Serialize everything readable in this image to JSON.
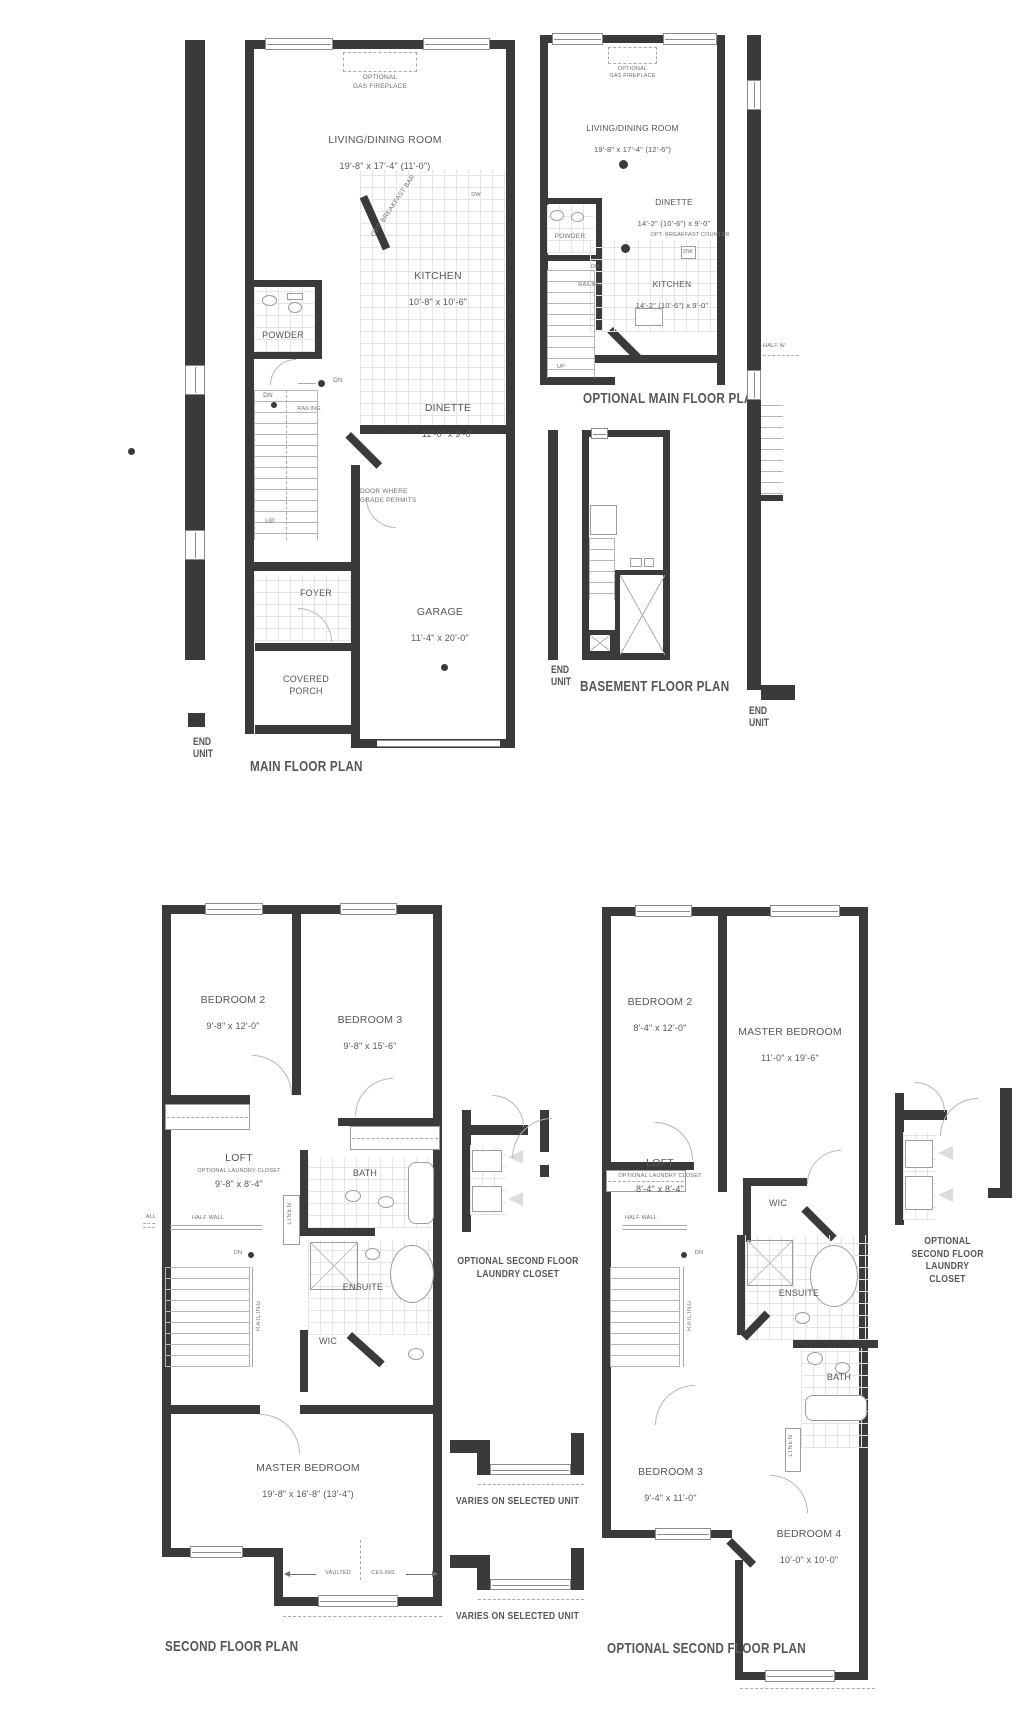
{
  "sheet": {
    "bg": "#ffffff",
    "wall_color": "#3a3a3c",
    "line_color": "#a7a9ac",
    "label_color": "#55575b",
    "title_color": "#55565a"
  },
  "main_floor": {
    "title": "MAIN FLOOR PLAN",
    "end_unit_label": "END\nUNIT",
    "optional_gas_fireplace": "OPTIONAL\nGAS FIREPLACE",
    "living_dining": {
      "name": "LIVING/DINING ROOM",
      "dims": "19'-8\" x 17'-4\" (11'-0\")"
    },
    "opt_breakfast_bar": "OPT. BREAKFAST BAR",
    "kitchen": {
      "name": "KITCHEN",
      "dims": "10'-8\" x 10'-6\""
    },
    "dw": "DW",
    "powder": "POWDER",
    "dinette": {
      "name": "DINETTE",
      "dims": "11'-0\" x 9'-0\""
    },
    "dn_upper": "DN",
    "dn_lower": "DN",
    "up": "UP",
    "railing": "RAILING",
    "door_note": "DOOR WHERE\nGRADE PERMITS",
    "foyer": "FOYER",
    "garage": {
      "name": "GARAGE",
      "dims": "11'-4\" x 20'-0\""
    },
    "covered_porch": "COVERED\nPORCH"
  },
  "optional_main": {
    "title": "OPTIONAL MAIN FLOOR PLAN",
    "optional_gas_fireplace": "OPTIONAL\nGAS FIREPLACE",
    "living_dining": {
      "name": "LIVING/DINING ROOM",
      "dims": "19'-8\" x 17'-4\" (12'-6\")"
    },
    "dinette": {
      "name": "DINETTE",
      "dims": "14'-2\" (10'-6\") x 9'-0\""
    },
    "powder": "POWDER",
    "opt_breakfast_counter": "OPT. BREAKFAST COUNTER",
    "kitchen": {
      "name": "KITCHEN",
      "dims": "14'-2\" (10'-6\") x 9'-0\""
    },
    "dw": "DW",
    "dn": "DN",
    "railing": "RAILING",
    "up": "UP"
  },
  "basement": {
    "title": "BASEMENT FLOOR PLAN",
    "end_unit_label": "END\nUNIT"
  },
  "end_wall": {
    "half_wall": "HALF W",
    "end_unit_label": "END\nUNIT"
  },
  "second_floor": {
    "title": "SECOND FLOOR PLAN",
    "bedroom2": {
      "name": "BEDROOM 2",
      "dims": "9'-8\" x 12'-0\""
    },
    "bedroom3": {
      "name": "BEDROOM 3",
      "dims": "9'-8\" x 15'-6\""
    },
    "loft": {
      "name": "LOFT",
      "dims": "9'-8\" x 8'-4\"",
      "note": "OPTIONAL LAUNDRY CLOSET"
    },
    "bath": "BATH",
    "linen": "LINEN",
    "half_wall": "HALF WALL",
    "side_note": "ALL",
    "dn": "DN",
    "railing": "RAILING",
    "ensuite": "ENSUITE",
    "wic": "WIC",
    "master": {
      "name": "MASTER BEDROOM",
      "dims": "19'-8\" x 16'-8\" (13'-4\")"
    },
    "vaulted_left": "VAULTED",
    "vaulted_right": "CEILING"
  },
  "optional_second": {
    "title": "OPTIONAL SECOND FLOOR PLAN",
    "bedroom2": {
      "name": "BEDROOM 2",
      "dims": "8'-4\" x 12'-0\""
    },
    "master": {
      "name": "MASTER BEDROOM",
      "dims": "11'-0\" x 19'-6\""
    },
    "loft": {
      "name": "LOFT",
      "dims": "8'-4\" x 8'-4\"",
      "note": "OPTIONAL LAUNDRY CLOSET"
    },
    "half_wall": "HALF WALL",
    "dn": "DN",
    "railing": "RAILING",
    "wic": "WIC",
    "ensuite": "ENSUITE",
    "bath": "BATH",
    "linen": "LINEN",
    "bedroom3": {
      "name": "BEDROOM 3",
      "dims": "9'-4\" x 11'-0\""
    },
    "bedroom4": {
      "name": "BEDROOM 4",
      "dims": "10'-0\" x 10'-0\""
    }
  },
  "details": {
    "laundry_center_label": "OPTIONAL SECOND FLOOR\nLAUNDRY CLOSET",
    "varies_1": "VARIES ON SELECTED UNIT",
    "varies_2": "VARIES ON SELECTED UNIT",
    "laundry_right_label": "OPTIONAL\nSECOND FLOOR\nLAUNDRY CLOSET"
  }
}
